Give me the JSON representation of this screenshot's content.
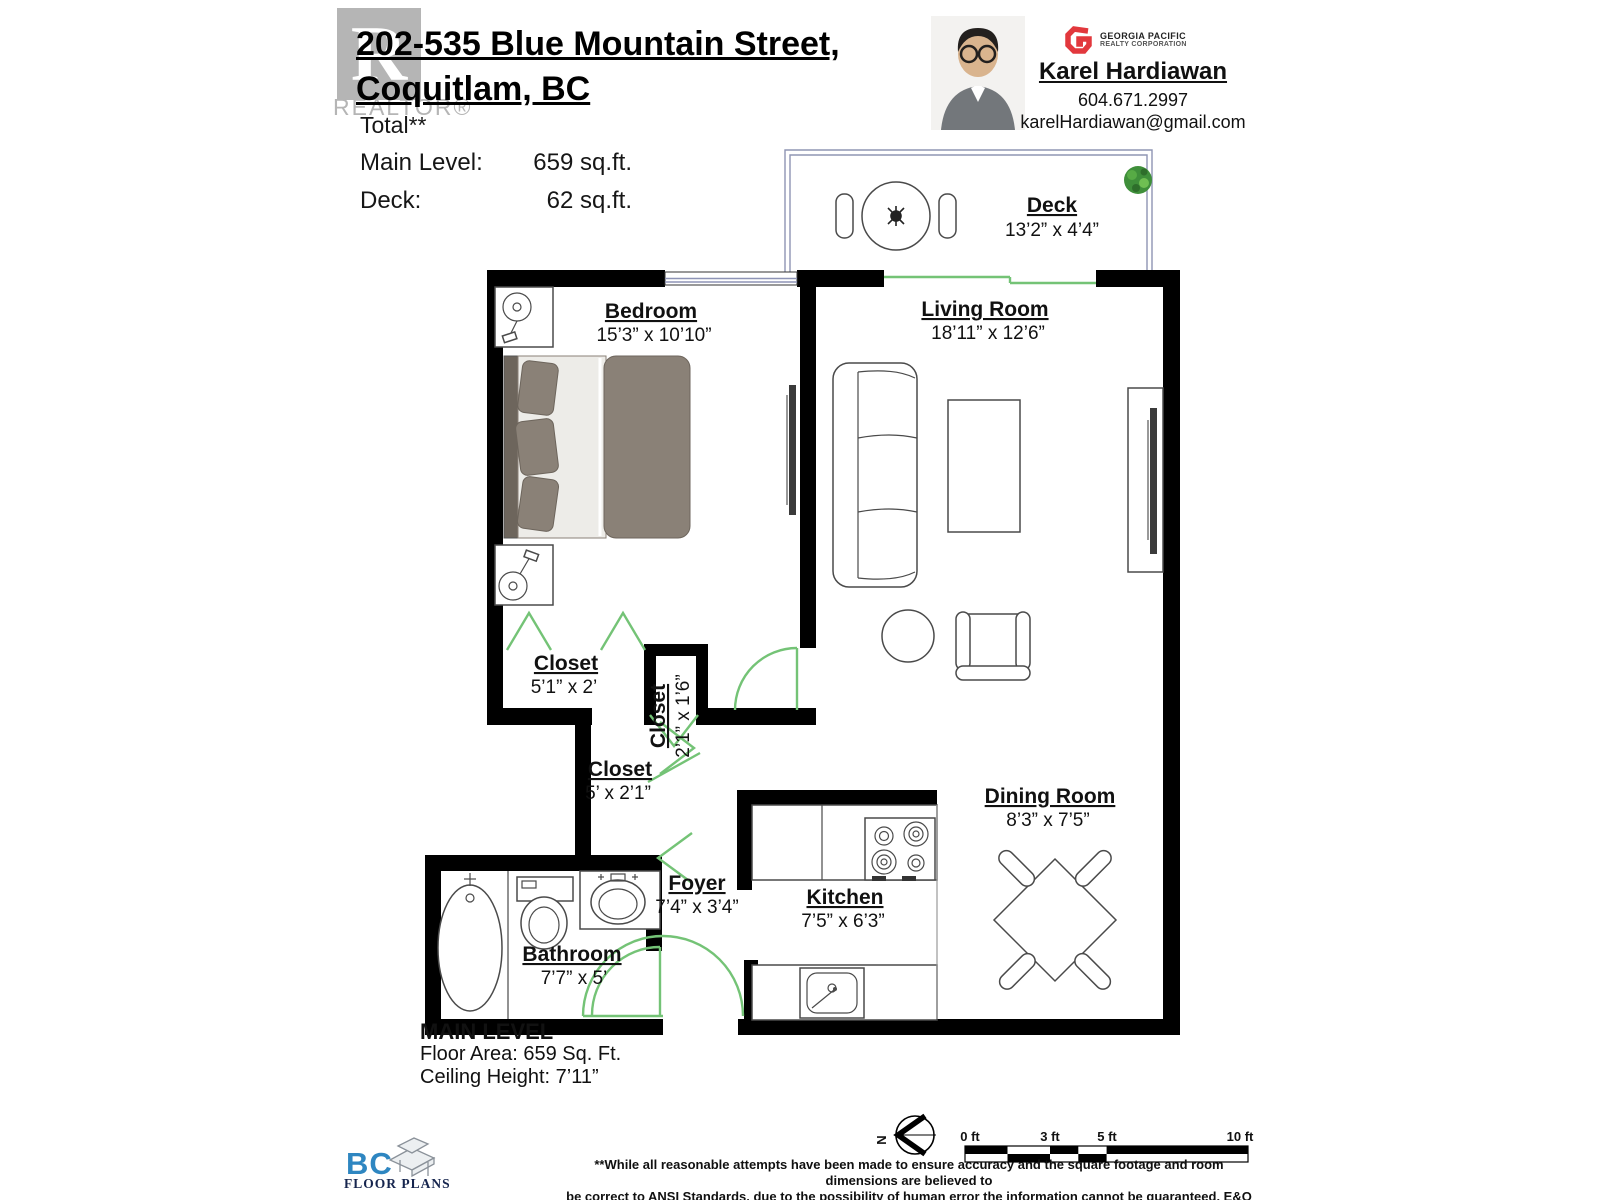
{
  "header": {
    "watermark": {
      "letter": "R",
      "label": "REALTOR®"
    },
    "address_line1": "202-535 Blue Mountain Street,",
    "address_line2": "Coquitlam, BC",
    "stats": {
      "total_label": "Total**",
      "rows": [
        {
          "label": "Main Level:",
          "value": "659 sq.ft."
        },
        {
          "label": "Deck:",
          "value": "62 sq.ft."
        }
      ]
    },
    "agent": {
      "name": "Karel Hardiawan",
      "phone": "604.671.2997",
      "email": "karelHardiawan@gmail.com",
      "brokerage_line1": "GEORGIA PACIFIC",
      "brokerage_line2": "REALTY CORPORATION"
    }
  },
  "rooms": {
    "deck": {
      "name": "Deck",
      "dims": "13’2” x 4’4”"
    },
    "bedroom": {
      "name": "Bedroom",
      "dims": "15’3” x 10’10”"
    },
    "living": {
      "name": "Living Room",
      "dims": "18’11” x 12’6”"
    },
    "closet_bedroom": {
      "name": "Closet",
      "dims": "5’1” x 2’"
    },
    "closet_small": {
      "name": "Closet",
      "dims": "2’1” x 1’6”"
    },
    "closet_hall": {
      "name": "Closet",
      "dims": "5’ x 2’1”"
    },
    "dining": {
      "name": "Dining Room",
      "dims": "8’3” x 7’5”"
    },
    "kitchen": {
      "name": "Kitchen",
      "dims": "7’5” x 6’3”"
    },
    "foyer": {
      "name": "Foyer",
      "dims": "7’4” x 3’4”"
    },
    "bathroom": {
      "name": "Bathroom",
      "dims": "7’7” x 5’"
    }
  },
  "footer": {
    "level_title": "MAIN LEVEL",
    "floor_area": "Floor Area: 659 Sq. Ft.",
    "ceiling_height": "Ceiling Height: 7’11”",
    "bc_logo": {
      "bc": "BC",
      "floor_plans": "FLOOR PLANS"
    },
    "compass_n": "N",
    "scale_labels": [
      "0 ft",
      "3 ft",
      "5 ft",
      "10 ft"
    ],
    "disclaimer_line1": "**While all reasonable attempts have been made to ensure accuracy and the square footage and room dimensions are believed to",
    "disclaimer_line2": "be correct to ANSI Standards, due to the possibility of human error the information cannot be guaranteed. E&O Insured for $1,000,000"
  },
  "colors": {
    "wall": "#000000",
    "door_green": "#74c376",
    "window_blue": "#8e94b6",
    "bed_taupe": "#8a8177",
    "accent_red": "#e2383d",
    "bc_blue": "#2e86c1",
    "bc_navy": "#16254e",
    "watermark_gray": "#b5b5b5"
  }
}
